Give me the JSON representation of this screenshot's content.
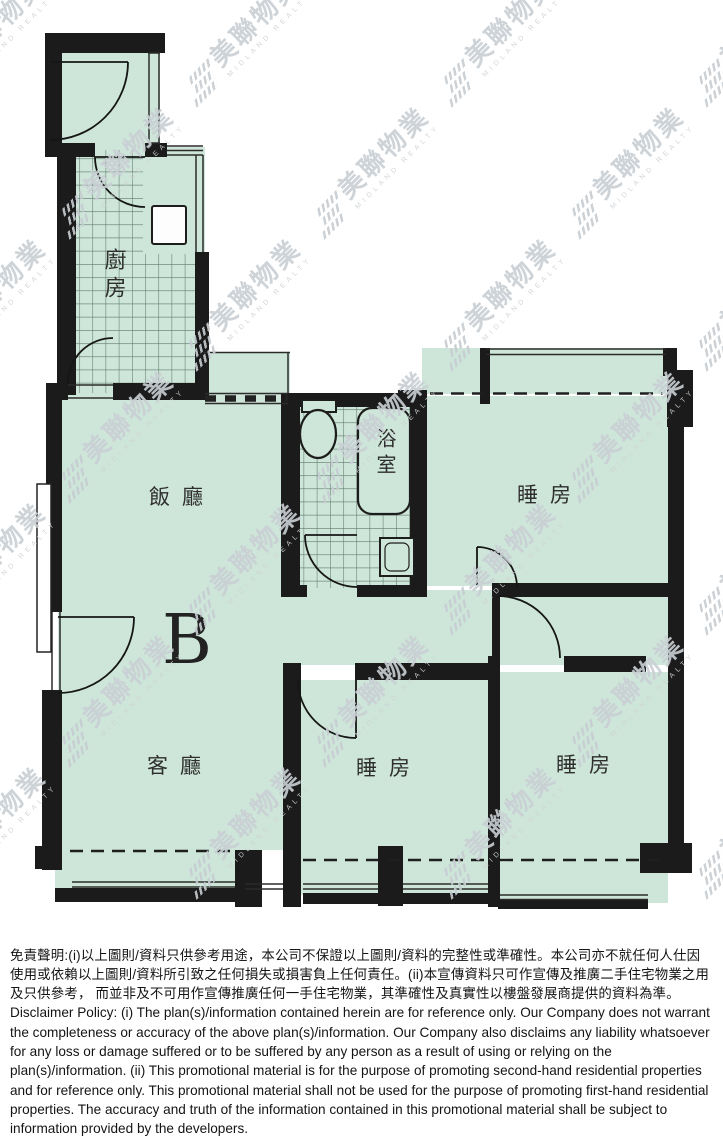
{
  "plan": {
    "unit_label": "B",
    "rooms": {
      "kitchen": "廚房",
      "dining": "飯廳",
      "living": "客廳",
      "bathroom": "浴室",
      "bedroom_top": "睡房",
      "bedroom_middle": "睡房",
      "bedroom_right": "睡房"
    },
    "colors": {
      "floor": "#cee6d9",
      "wall": "#1b1b1b",
      "label_ink": "#2e2e2e"
    }
  },
  "watermark": {
    "cjk": "美聯物業",
    "latin": "MIDLAND REALTY"
  },
  "disclaimer": {
    "zh": "免責聲明:(i)以上圖則/資料只供參考用途，本公司不保證以上圖則/資料的完整性或準確性。本公司亦不就任何人仕因使用或依賴以上圖則/資料所引致之任何損失或損害負上任何責任。(ii)本宣傳資料只可作宣傳及推廣二手住宅物業之用及只供參考， 而並非及不可用作宣傳推廣任何一手住宅物業，其準確性及真實性以樓盤發展商提供的資料為準。",
    "en": "Disclaimer Policy: (i) The plan(s)/information contained herein are for reference only. Our Company does not warrant the completeness or accuracy of the above plan(s)/information. Our Company also disclaims any liability whatsoever for any loss or damage suffered or to be suffered by any person as a result of using or relying on the plan(s)/information. (ii) This promotional material is for the purpose of promoting second-hand residential properties and for reference only. This promotional material shall not be used for the purpose of promoting first-hand residential properties. The accuracy and truth of the information contained in this promotional material shall be subject to information provided by the developers."
  }
}
